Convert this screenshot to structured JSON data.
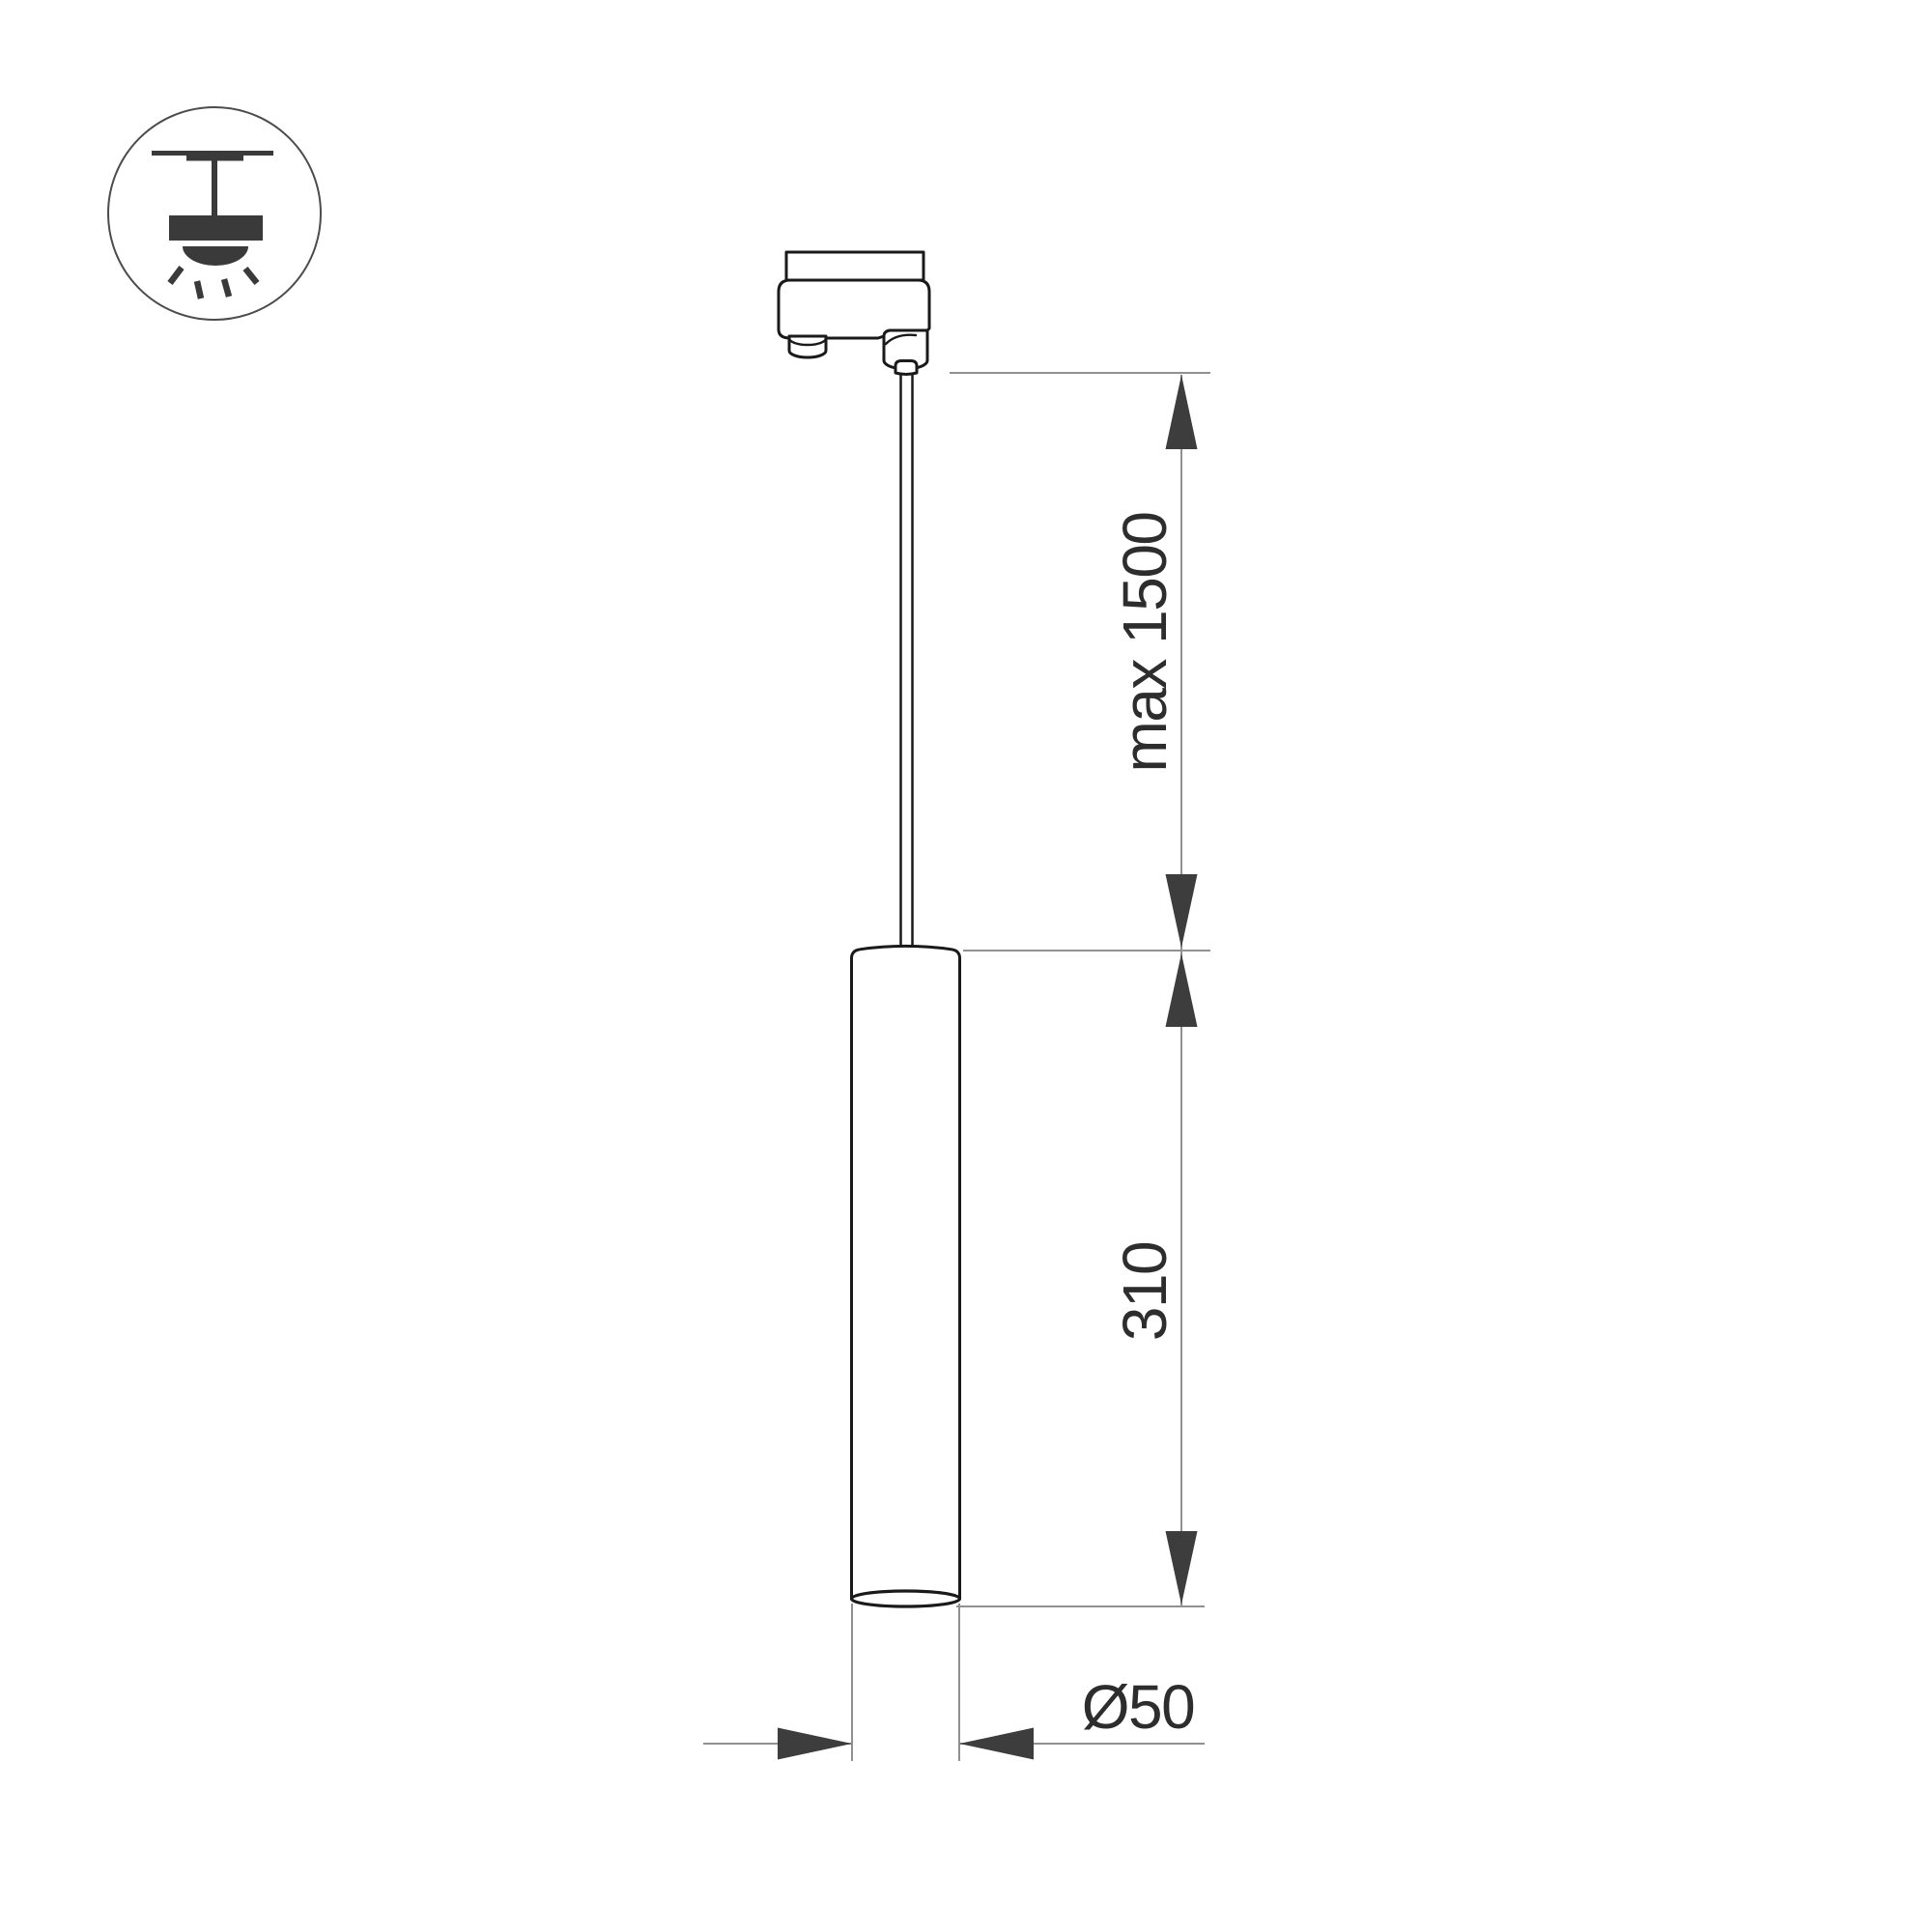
{
  "icon": {
    "name": "ceiling-pendant-mount-icon"
  },
  "dimensions": {
    "suspension_length": "max 1500",
    "body_height": "310",
    "body_diameter": "Ø50"
  },
  "colors": {
    "background": "#ffffff",
    "outline": "#1a1a1a",
    "dimension_line": "#919191",
    "arrow_fill": "#3d3d3d",
    "label_text": "#2d2d2d",
    "icon_fill": "#3a3a3a"
  }
}
